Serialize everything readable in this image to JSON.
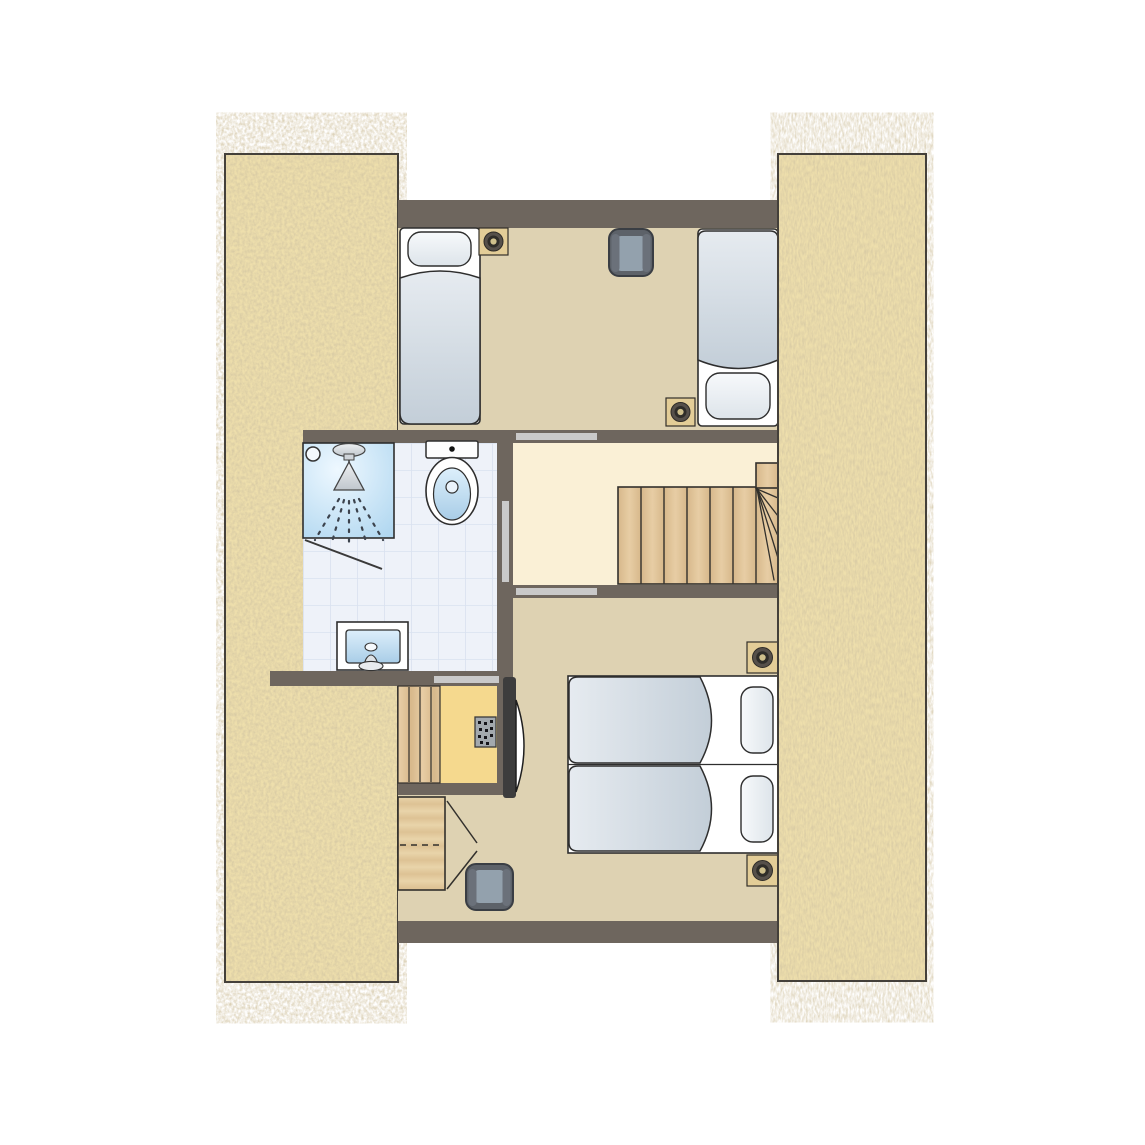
{
  "canvas": {
    "width": 1145,
    "height": 1145,
    "background": "#ffffff",
    "aria_label": "Attic floor plan: two bedrooms, bathroom with shower, toilet and washbasin, stair landing with winder staircase, closet with control panel, thatched roof bands left and right"
  },
  "palette": {
    "wall": "#6e665e",
    "roof_base": "#eedfac",
    "roof_grain": "#a38c5c",
    "roof_border": "#44403a",
    "bedroom_floor": "#ded2b2",
    "landing_floor": "#faf0d6",
    "closet_floor": "#f5d98e",
    "tile_floor": "#eef2f9",
    "tile_grid": "#d9e1ef",
    "door_marker": "#c9c9c9",
    "outline": "#32302c",
    "bed_line": "#2e2e2e",
    "mattress": "#ffffff",
    "duvet_light": "#e6ebf0",
    "duvet_dark": "#c3ced8",
    "chair_body": "#5d6269",
    "chair_seat": "#93a1ad",
    "chair_arm": "#6b717a",
    "spot_plate": "#e3cd97",
    "spot_ring_outer": "#56504a",
    "spot_ring_inner": "#2f2d29",
    "spot_center": "#cfc08c",
    "wood_light": "#e7cda4",
    "wood_dark": "#d7b88b",
    "panel_body": "#a3a9ae",
    "panel_dot": "#15151a",
    "tv_dark": "#3d3d3d",
    "shower_blue": "#a9d3ee",
    "basin_blue": "#a9cde7"
  },
  "elements": {
    "roof": [
      {
        "id": "roof-band-left",
        "type": "thatched-roof-slope"
      },
      {
        "id": "roof-band-right",
        "type": "thatched-roof-slope"
      }
    ],
    "rooms": [
      {
        "id": "bedroom-top",
        "type": "bedroom",
        "floor_color": "#ded2b2"
      },
      {
        "id": "stair-landing",
        "type": "landing",
        "floor_color": "#faf0d6"
      },
      {
        "id": "bathroom",
        "type": "bathroom",
        "floor_color": "#eef2f9"
      },
      {
        "id": "closet",
        "type": "closet",
        "floor_color": "#f5d98e"
      },
      {
        "id": "bedroom-bottom",
        "type": "bedroom",
        "floor_color": "#ded2b2"
      }
    ],
    "doors": [
      {
        "id": "door-marker-bedroom-top",
        "type": "door-opening"
      },
      {
        "id": "door-marker-bedroom-bottom",
        "type": "door-opening"
      },
      {
        "id": "door-marker-closet",
        "type": "door-opening"
      },
      {
        "id": "door-marker-bathroom",
        "type": "door-opening"
      }
    ],
    "furniture": [
      {
        "id": "single-bed-top-left",
        "type": "single-bed"
      },
      {
        "id": "single-bed-top-right",
        "type": "single-bed"
      },
      {
        "id": "armchair-top",
        "type": "armchair"
      },
      {
        "id": "twin-bed-upper",
        "type": "single-bed"
      },
      {
        "id": "twin-bed-lower",
        "type": "single-bed"
      },
      {
        "id": "armchair-bottom",
        "type": "armchair"
      },
      {
        "id": "wardrobe",
        "type": "wardrobe"
      },
      {
        "id": "wall-tv",
        "type": "wall-mounted-tv"
      }
    ],
    "fixtures": [
      {
        "id": "shower",
        "type": "shower-with-head-and-spray"
      },
      {
        "id": "toilet",
        "type": "toilet"
      },
      {
        "id": "washbasin",
        "type": "washbasin-with-tap"
      },
      {
        "id": "staircase-upper",
        "type": "winder-staircase"
      },
      {
        "id": "staircase-lower-planks",
        "type": "stair-planks"
      },
      {
        "id": "control-panel",
        "type": "control-panel"
      }
    ],
    "lights": [
      {
        "id": "spotlight-1",
        "type": "ceiling-spotlight"
      },
      {
        "id": "spotlight-2",
        "type": "ceiling-spotlight"
      },
      {
        "id": "spotlight-3",
        "type": "ceiling-spotlight"
      },
      {
        "id": "spotlight-4",
        "type": "ceiling-spotlight"
      }
    ]
  }
}
